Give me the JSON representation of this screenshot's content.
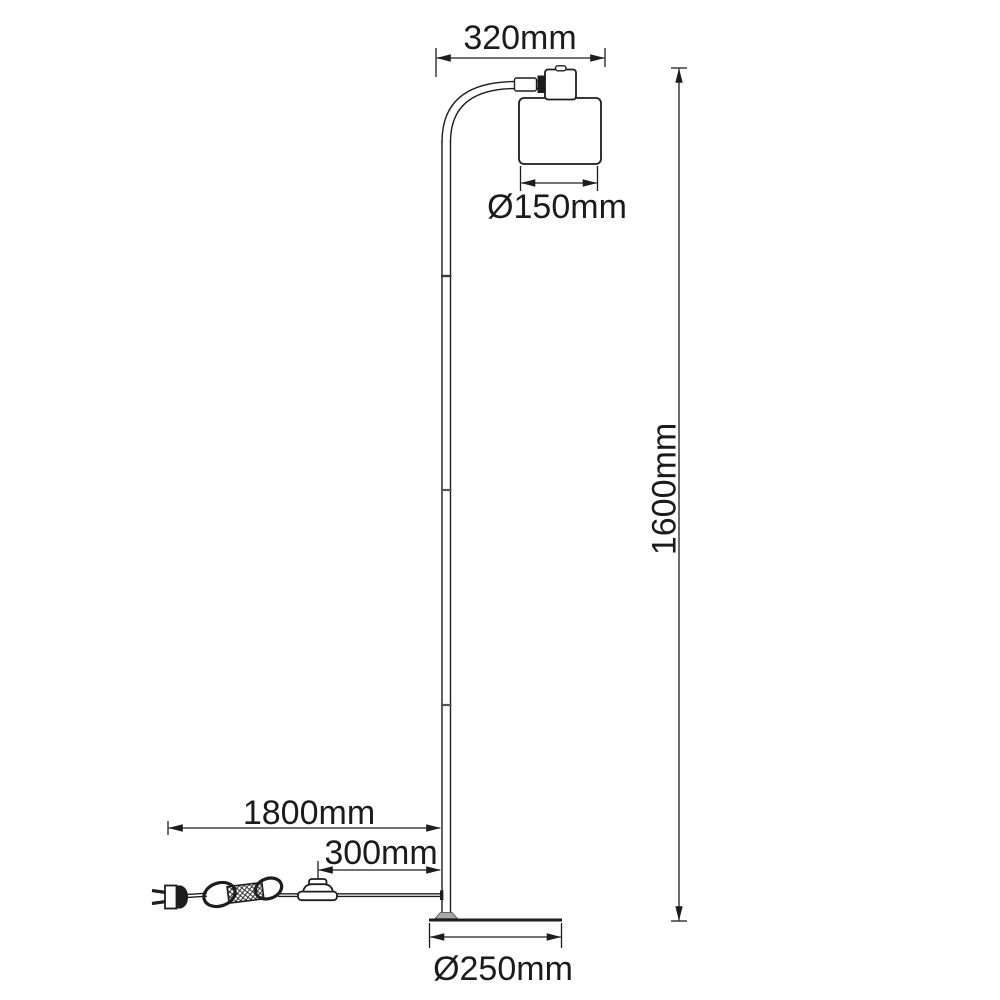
{
  "drawing": {
    "title": "Floor lamp dimension drawing",
    "unit": "mm",
    "labels": {
      "head_width": "320mm",
      "shade_diameter": "Ø150mm",
      "total_height": "1600mm",
      "cord_length": "1800mm",
      "switch_to_pole": "300mm",
      "base_diameter": "Ø250mm"
    },
    "values_mm": {
      "head_width": 320,
      "shade_diameter": 150,
      "total_height": 1600,
      "cord_length": 1800,
      "switch_to_pole": 300,
      "base_diameter": 250
    },
    "colors": {
      "background": "#ffffff",
      "line": "#1d1d1d"
    }
  }
}
